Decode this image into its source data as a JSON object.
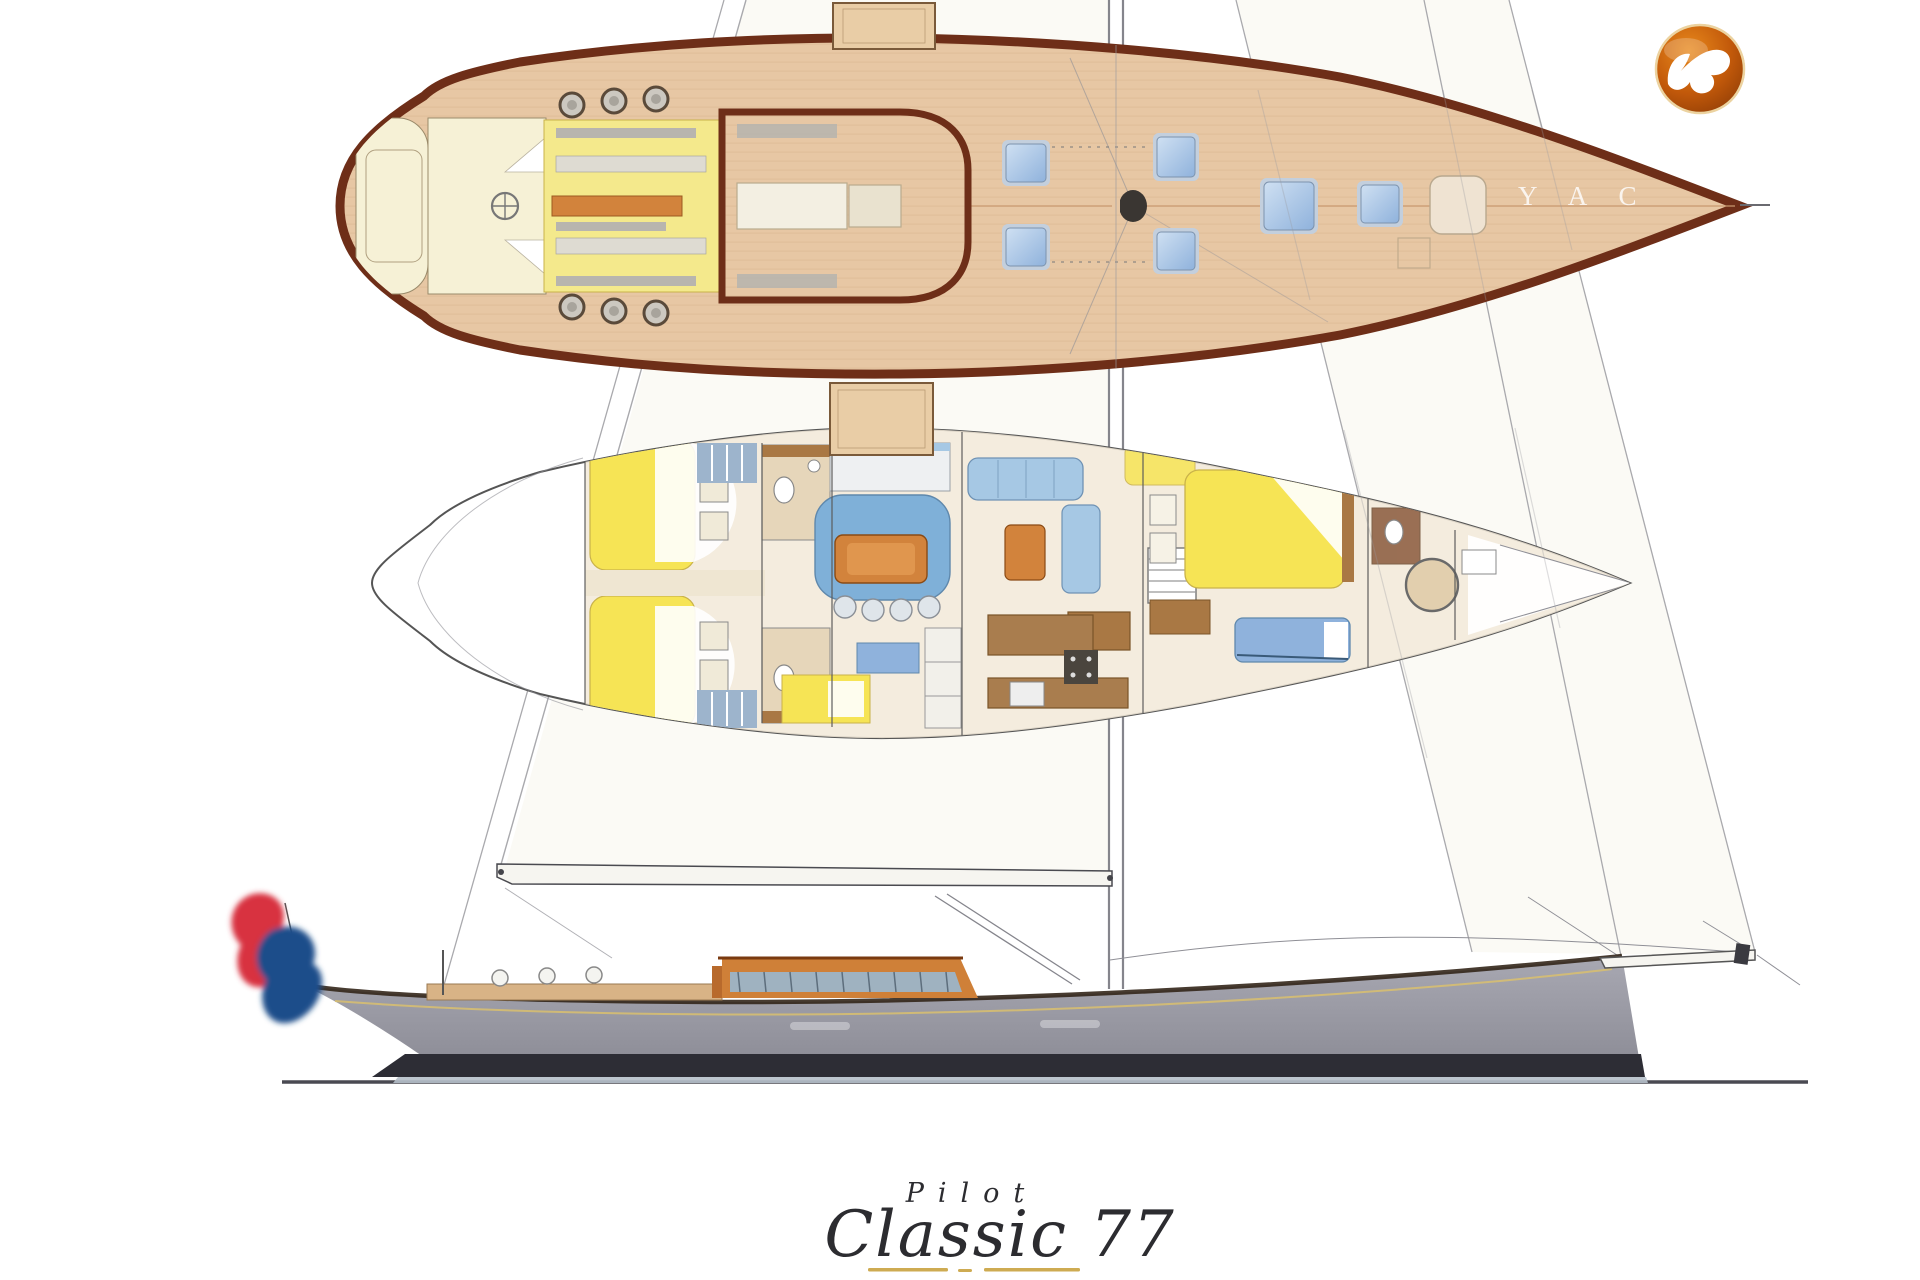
{
  "page": {
    "width": 1920,
    "height": 1280,
    "background": "#ffffff"
  },
  "branding": {
    "series_label": "Pilot",
    "model_name": "Classic 77",
    "watermark": "Y A C",
    "logo_icon": "seagull-badge-icon"
  },
  "drawing": {
    "views": [
      "deck-plan-top-view",
      "interior-accommodation-plan",
      "sail-plan-profile"
    ],
    "flag_colors": [
      "#d8303f",
      "#ffffff",
      "#1f4d8a"
    ]
  },
  "colors": {
    "deck_tan": "#e7c7a4",
    "plank_line": "#d9b48e",
    "caprail": "#6e2e18",
    "cockpit_cream": "#f6f1d6",
    "seat_yellow": "#f4e98c",
    "berth_yellow": "#f6e455",
    "bench_grey": "#b8b5ae",
    "table_orange": "#d2833c",
    "hatch_blue": "#8fb2dc",
    "hatch_frame": "#c3cfdd",
    "interior_floor": "#f2e9d8",
    "settee_blue": "#a6c8e4",
    "settee_blue_dark": "#7fb0d8",
    "wood_brown": "#a97844",
    "hull_grey_top": "#a8a8b2",
    "hull_grey_bottom": "#8e8e98",
    "waterline_dark": "#2d2d35",
    "boot_light": "#b6c0ca",
    "house_orange": "#cf8038",
    "house_window": "#9fb2c0",
    "coaming_tan": "#d8b386",
    "sail_line": "#a9a9ad",
    "mast_grey": "#85858c",
    "spar_white": "#f6f5f0",
    "title_ink": "#2c2c30",
    "underline_gold": "#c9a23f",
    "logo_orange": "#e8891c",
    "logo_orange_dark": "#8a3a06",
    "logo_ring": "#ecd3a0",
    "flag_red": "#d8303f",
    "flag_blue": "#1f4d8a"
  }
}
